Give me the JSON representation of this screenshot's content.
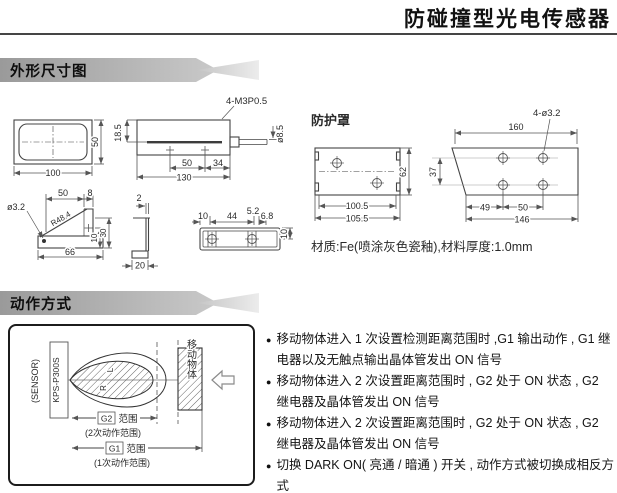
{
  "title": "防碰撞型光电传感器",
  "sections": {
    "dimensions": {
      "header": "外形尺寸图"
    },
    "operation": {
      "header": "动作方式"
    }
  },
  "dims": {
    "front": {
      "w": "100",
      "h": "50"
    },
    "side": {
      "screws": "4-M3P0.5",
      "cable": "ø8.5",
      "h_slit": "18.5",
      "d50": "50",
      "d34": "34",
      "d130": "130"
    },
    "cover": {
      "label": "防护罩",
      "w_inner": "100.5",
      "w_outer": "105.5",
      "h": "62"
    },
    "plate": {
      "holes": "4-ø3.2",
      "w_top": "160",
      "row_gap": "37",
      "d49": "49",
      "d50": "50",
      "w_bottom": "146"
    },
    "arm": {
      "hole": "ø3.2",
      "d50": "50",
      "d8": "8",
      "radius": "R48.4",
      "d10": "10",
      "d30": "30",
      "d66": "66"
    },
    "profile": {
      "d2": "2",
      "d20": "20"
    },
    "clamp": {
      "d10a": "10",
      "d44": "44",
      "d52": "5.2",
      "d68": "6.8",
      "d10b": "10"
    },
    "material": "材质:Fe(喷涂灰色瓷釉),材料厚度:1.0mm"
  },
  "diagram": {
    "sensor": "(SENSOR)",
    "model": "KPS-P300S",
    "beam_l": "L",
    "beam_r": "R",
    "object": "移动物体",
    "g2": {
      "tag": "G2",
      "range": "范围",
      "sub": "(2次动作范围)"
    },
    "g1": {
      "tag": "G1",
      "range": "范围",
      "sub": "(1次动作范围)"
    }
  },
  "notes": {
    "bullet": "●",
    "items": [
      "移动物体进入 1 次设置检测距离范围时 ,G1 输出动作 , G1 继电器以及无触点输出晶体管发出 ON 信号",
      "移动物体进入 2 次设置距离范围时 , G2 处于 ON 状态 , G2 继电器及晶体管发出 ON 信号",
      "移动物体进入 2 次设置距离范围时 , G2 处于 ON 状态 , G2 继电器及晶体管发出 ON 信号",
      "切换 DARK ON( 亮通 / 暗通 ) 开关 , 动作方式被切换成相反方式"
    ]
  }
}
